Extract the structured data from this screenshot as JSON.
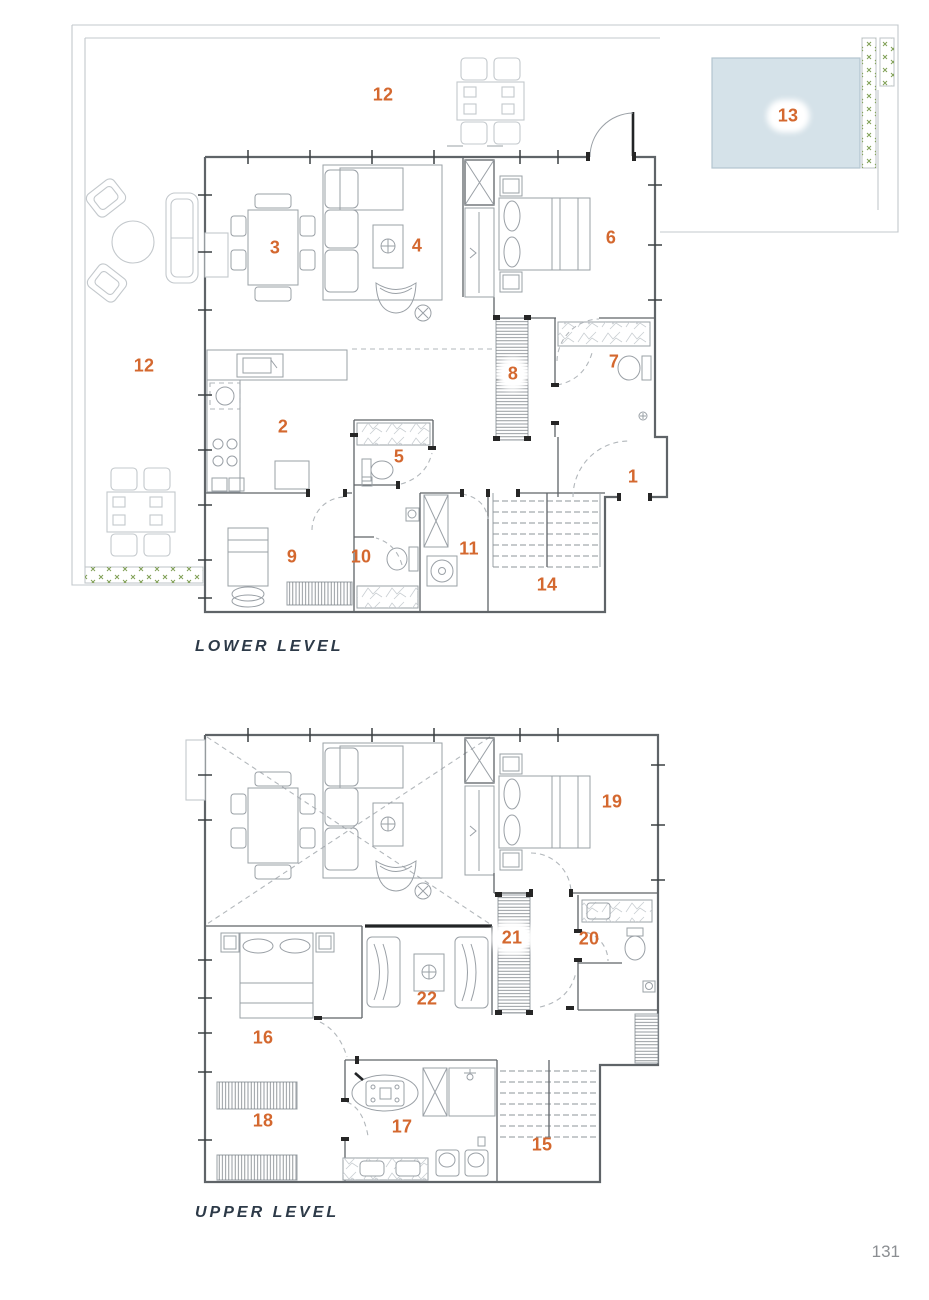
{
  "page": {
    "number": "131"
  },
  "colors": {
    "accent": "#d4682f",
    "title": "#2d3a48",
    "wall": "#5f6468",
    "furniture": "#9aa0a6",
    "light": "#c3c8cc",
    "dashed": "#b2b7bb",
    "pool_fill": "#d5e2e9",
    "pool_stroke": "#b3c5cf",
    "plant": "#7f9f55",
    "page_gray": "#8b8e92"
  },
  "lower_level": {
    "title": "LOWER LEVEL",
    "labels": [
      {
        "text": "12",
        "x": 383,
        "y": 95
      },
      {
        "text": "13",
        "x": 788,
        "y": 116,
        "halo": true
      },
      {
        "text": "3",
        "x": 275,
        "y": 248
      },
      {
        "text": "4",
        "x": 417,
        "y": 246
      },
      {
        "text": "6",
        "x": 611,
        "y": 238
      },
      {
        "text": "7",
        "x": 614,
        "y": 362
      },
      {
        "text": "8",
        "x": 513,
        "y": 374,
        "halo": true
      },
      {
        "text": "12",
        "x": 144,
        "y": 366
      },
      {
        "text": "2",
        "x": 283,
        "y": 427
      },
      {
        "text": "5",
        "x": 399,
        "y": 457
      },
      {
        "text": "1",
        "x": 633,
        "y": 477
      },
      {
        "text": "9",
        "x": 292,
        "y": 557
      },
      {
        "text": "10",
        "x": 361,
        "y": 557
      },
      {
        "text": "11",
        "x": 469,
        "y": 549
      },
      {
        "text": "14",
        "x": 547,
        "y": 585
      }
    ]
  },
  "upper_level": {
    "title": "UPPER LEVEL",
    "labels": [
      {
        "text": "19",
        "x": 612,
        "y": 802
      },
      {
        "text": "21",
        "x": 512,
        "y": 938,
        "halo": true
      },
      {
        "text": "20",
        "x": 589,
        "y": 939
      },
      {
        "text": "22",
        "x": 427,
        "y": 999
      },
      {
        "text": "16",
        "x": 263,
        "y": 1038
      },
      {
        "text": "18",
        "x": 263,
        "y": 1121
      },
      {
        "text": "17",
        "x": 402,
        "y": 1127
      },
      {
        "text": "15",
        "x": 542,
        "y": 1145
      }
    ]
  }
}
